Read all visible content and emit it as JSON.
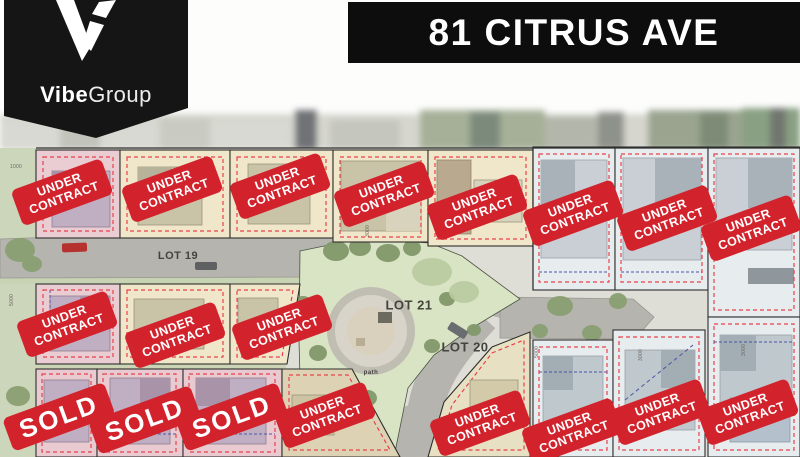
{
  "brand": {
    "name_bold": "Vibe",
    "name_light": "Group",
    "mark": "v-logo-mark"
  },
  "banner": {
    "title": "81 CITRUS AVE"
  },
  "map": {
    "labels": [
      {
        "text": "LOT 19",
        "x": 178,
        "y": 256,
        "size": 11
      },
      {
        "text": "LOT 21",
        "x": 409,
        "y": 305,
        "size": 13
      },
      {
        "text": "LOT 20",
        "x": 465,
        "y": 347,
        "size": 13
      },
      {
        "text": "path",
        "x": 371,
        "y": 373,
        "size": 6
      }
    ],
    "dimensions": [
      {
        "text": "1000",
        "x": 16,
        "y": 167,
        "rot": 0
      },
      {
        "text": "3000",
        "x": 368,
        "y": 231,
        "rot": -90
      },
      {
        "text": "5000",
        "x": 537,
        "y": 352,
        "rot": -90
      },
      {
        "text": "3000",
        "x": 641,
        "y": 355,
        "rot": -90
      },
      {
        "text": "3000",
        "x": 744,
        "y": 350,
        "rot": -90
      },
      {
        "text": "5000",
        "x": 12,
        "y": 300,
        "rot": -90
      }
    ]
  },
  "badges": {
    "under_contract_line1": "UNDER",
    "under_contract_line2": "CONTRACT",
    "sold_label": "SOLD",
    "items": [
      {
        "type": "uc",
        "x": 62,
        "y": 192,
        "rot": -20
      },
      {
        "type": "uc",
        "x": 172,
        "y": 189,
        "rot": -20
      },
      {
        "type": "uc",
        "x": 280,
        "y": 186,
        "rot": -20
      },
      {
        "type": "uc",
        "x": 384,
        "y": 194,
        "rot": -20
      },
      {
        "type": "uc",
        "x": 477,
        "y": 207,
        "rot": -20
      },
      {
        "type": "uc",
        "x": 573,
        "y": 213,
        "rot": -20
      },
      {
        "type": "uc",
        "x": 667,
        "y": 218,
        "rot": -20
      },
      {
        "type": "uc",
        "x": 751,
        "y": 228,
        "rot": -20
      },
      {
        "type": "uc",
        "x": 67,
        "y": 324,
        "rot": -20
      },
      {
        "type": "uc",
        "x": 175,
        "y": 335,
        "rot": -20
      },
      {
        "type": "uc",
        "x": 282,
        "y": 327,
        "rot": -20
      },
      {
        "type": "uc",
        "x": 325,
        "y": 415,
        "rot": -20
      },
      {
        "type": "uc",
        "x": 480,
        "y": 423,
        "rot": -20
      },
      {
        "type": "uc",
        "x": 572,
        "y": 431,
        "rot": -20
      },
      {
        "type": "uc",
        "x": 660,
        "y": 412,
        "rot": -20
      },
      {
        "type": "uc",
        "x": 748,
        "y": 412,
        "rot": -20
      },
      {
        "type": "sold",
        "x": 59,
        "y": 417,
        "rot": -20
      },
      {
        "type": "sold",
        "x": 145,
        "y": 420,
        "rot": -20
      },
      {
        "type": "sold",
        "x": 232,
        "y": 417,
        "rot": -20
      }
    ]
  },
  "colors": {
    "badge_red": "#d2232c",
    "banner_black": "#0d0d0d",
    "pennant_black": "#151515",
    "lot_pink": "#eacdd3",
    "lot_beige": "#f0e7ca",
    "lot_blue": "#e7ecef",
    "dashed_red": "#e8414b",
    "park_green": "#d9e4c4",
    "road_gray": "#b5b4af"
  }
}
